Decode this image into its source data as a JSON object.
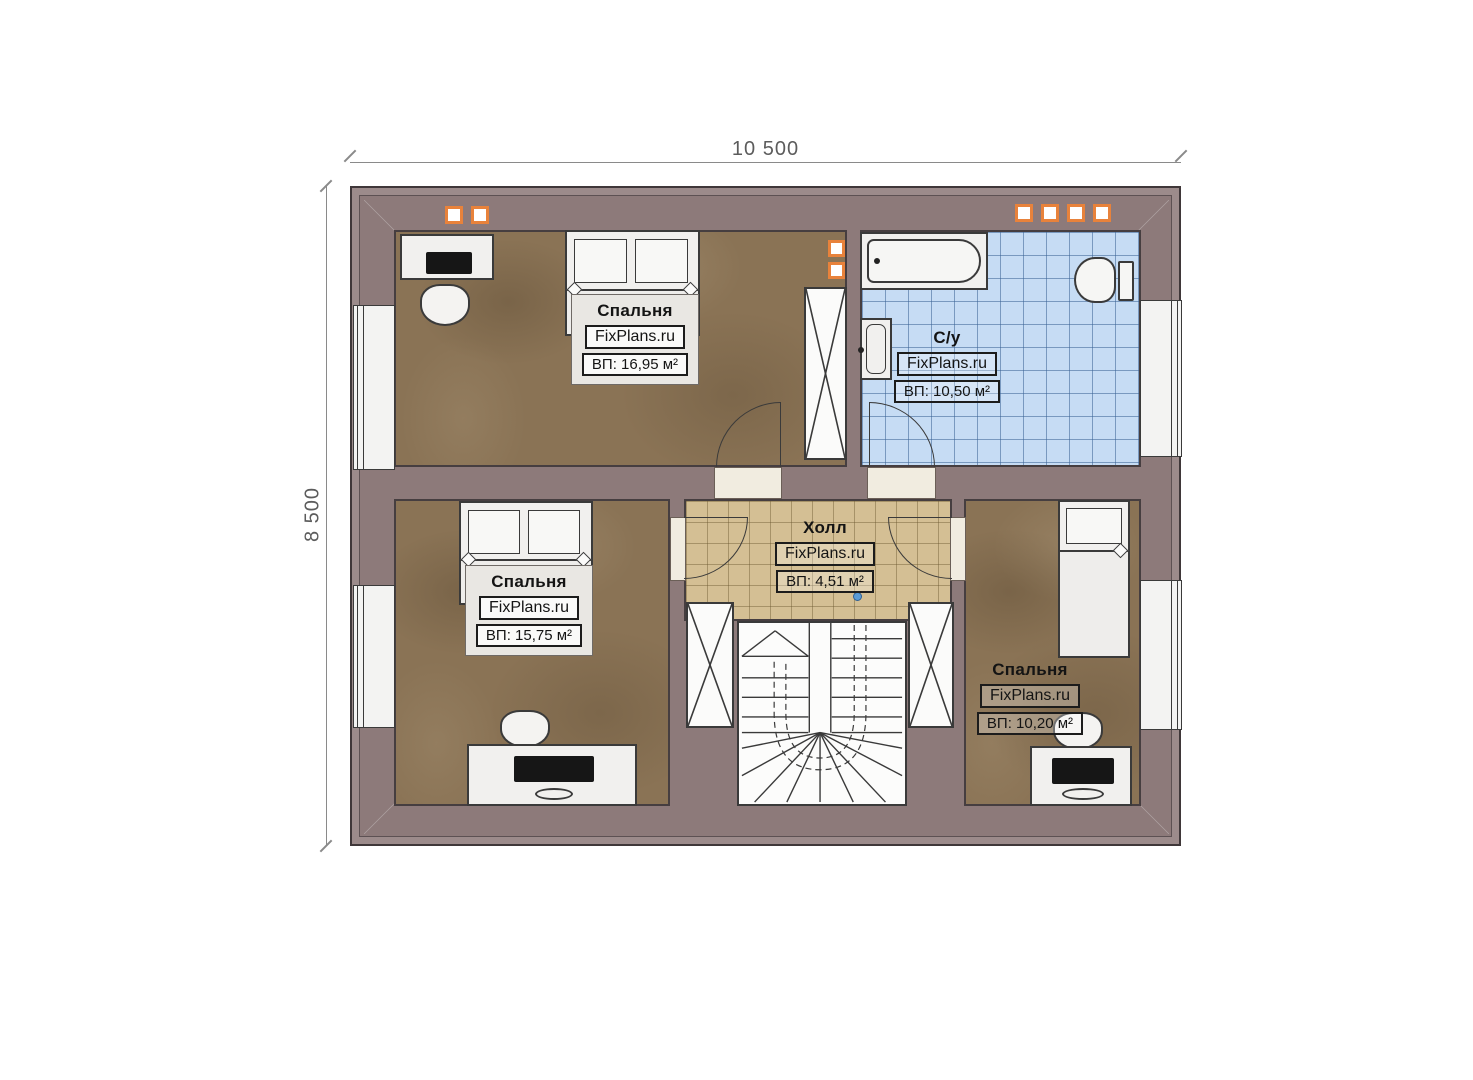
{
  "dimensions": {
    "width": "10 500",
    "height": "8 500"
  },
  "rooms": [
    {
      "name": "Спальня",
      "brand": "FixPlans.ru",
      "area": "ВП: 16,95 м²"
    },
    {
      "name": "С/у",
      "brand": "FixPlans.ru",
      "area": "ВП: 10,50 м²"
    },
    {
      "name": "Холл",
      "brand": "FixPlans.ru",
      "area": "ВП: 4,51 м²"
    },
    {
      "name": "Спальня",
      "brand": "FixPlans.ru",
      "area": "ВП: 15,75 м²"
    },
    {
      "name": "Спальня",
      "brand": "FixPlans.ru",
      "area": "ВП: 10,20 м²"
    }
  ],
  "colors": {
    "wall": "#8d7a7a",
    "wood_floor": "#8a7355",
    "bath_tile": "#c6dcf4",
    "hall_tile": "#d4bf94",
    "vent_accent": "#e8823b",
    "walk_dot": "#5a9bd6"
  }
}
